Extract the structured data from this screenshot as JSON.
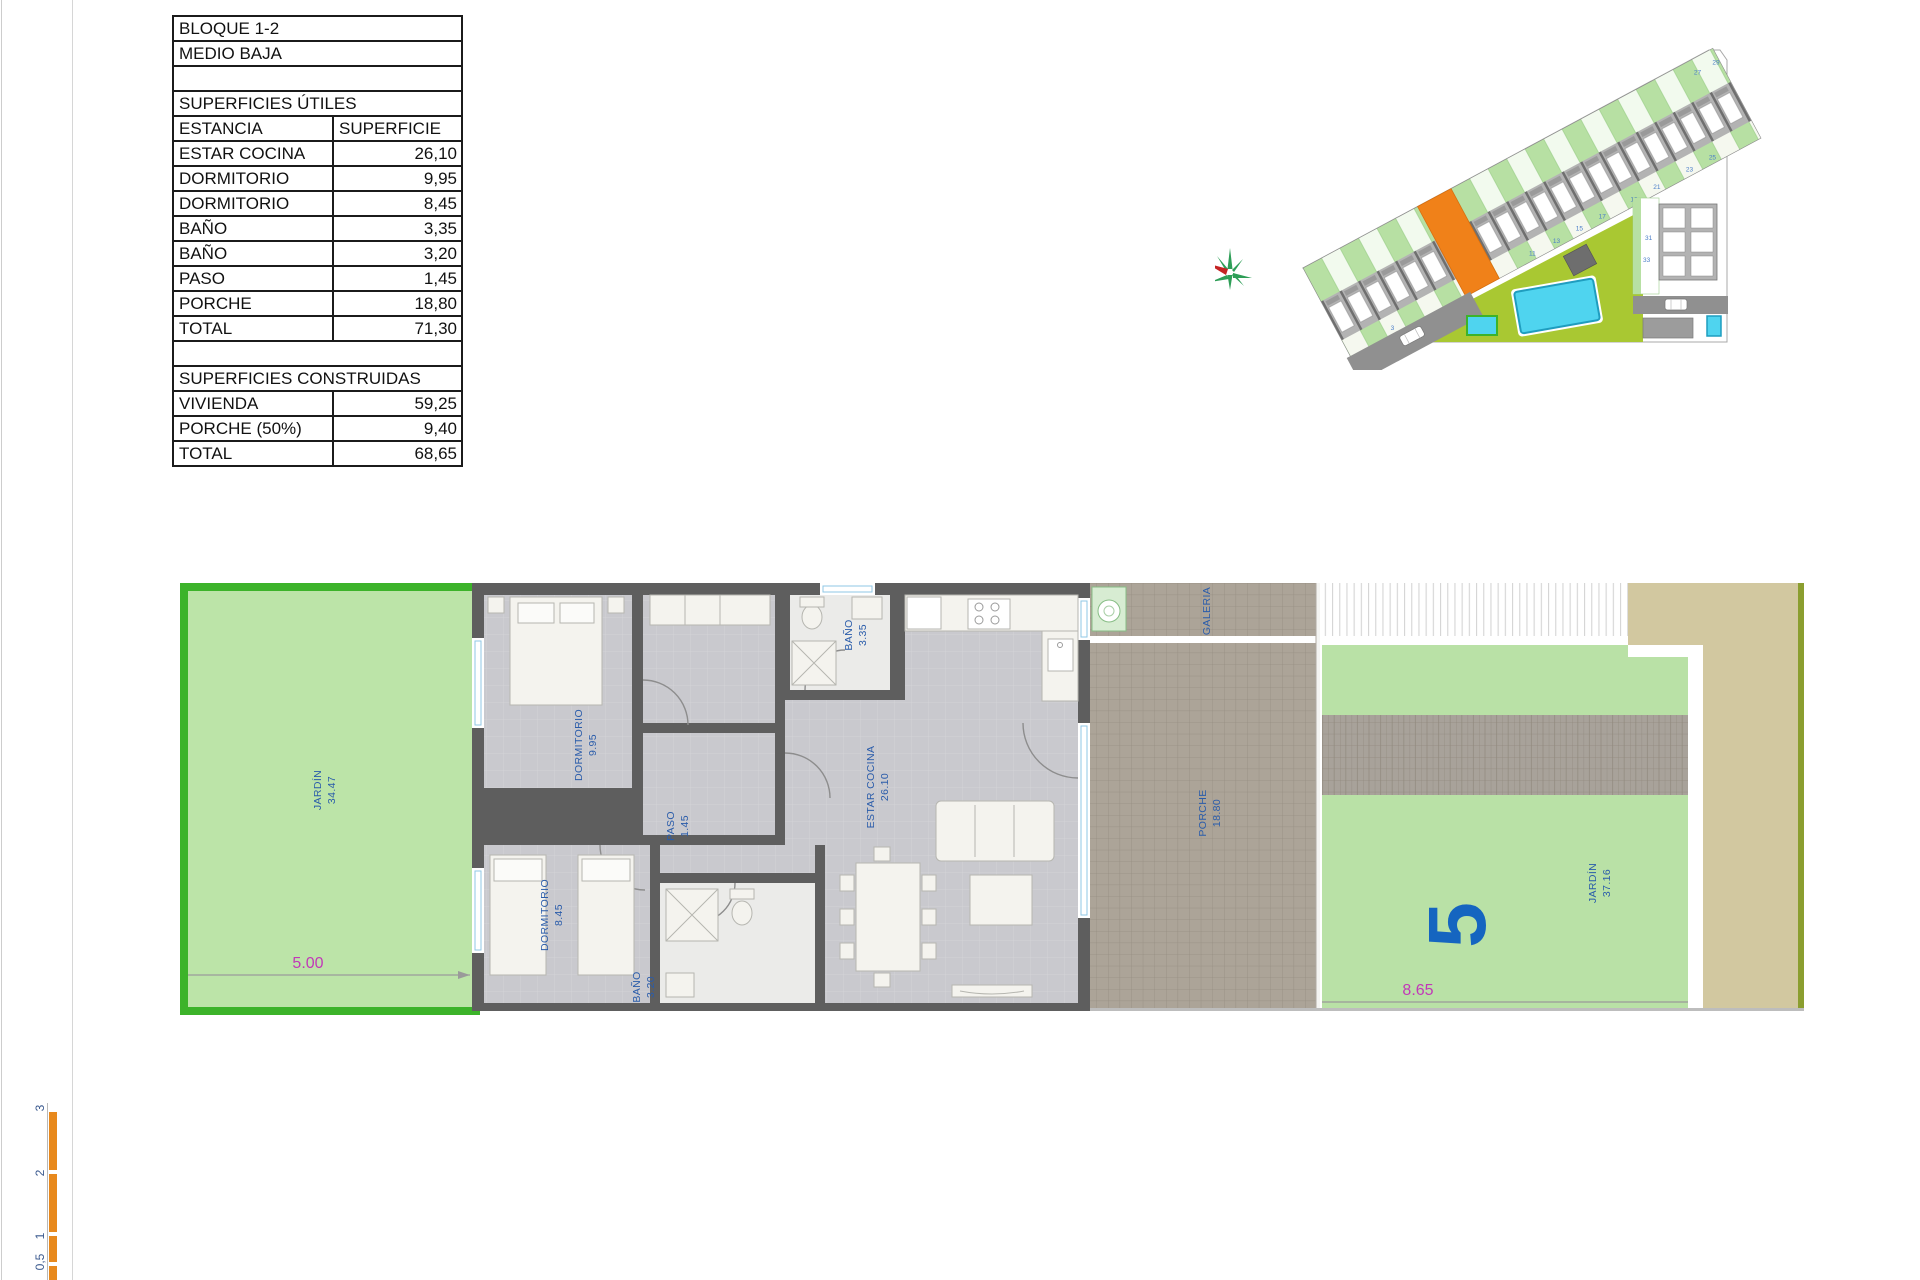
{
  "table": {
    "block": "BLOQUE 1-2",
    "floor": "MEDIO BAJA",
    "useful_title": "SUPERFICIES ÚTILES",
    "col_room": "ESTANCIA",
    "col_area": "SUPERFICIE",
    "useful_rows": [
      [
        "ESTAR COCINA",
        "26,10"
      ],
      [
        "DORMITORIO",
        "9,95"
      ],
      [
        "DORMITORIO",
        "8,45"
      ],
      [
        "BAÑO",
        "3,35"
      ],
      [
        "BAÑO",
        "3,20"
      ],
      [
        "PASO",
        "1,45"
      ],
      [
        "PORCHE",
        "18,80"
      ],
      [
        "TOTAL",
        "71,30"
      ]
    ],
    "built_title": "SUPERFICIES CONSTRUIDAS",
    "built_rows": [
      [
        "VIVIENDA",
        "59,25"
      ],
      [
        "PORCHE (50%)",
        "9,40"
      ],
      [
        "TOTAL",
        "68,65"
      ]
    ]
  },
  "plan": {
    "jardin_front": {
      "name": "JARDÍN",
      "area": "34.47"
    },
    "dormitorio1": {
      "name": "DORMITORIO",
      "area": "9.95"
    },
    "dormitorio2": {
      "name": "DORMITORIO",
      "area": "8.45"
    },
    "bano1": {
      "name": "BAÑO",
      "area": "3.35"
    },
    "bano2": {
      "name": "BAÑO",
      "area": "3.20"
    },
    "paso": {
      "name": "PASO",
      "area": "1.45"
    },
    "estar": {
      "name": "ESTAR COCINA",
      "area": "26.10"
    },
    "porche": {
      "name": "PORCHE",
      "area": "18.80"
    },
    "galeria": {
      "name": "GALERIA"
    },
    "jardin_back": {
      "name": "JARDÍN",
      "area": "37.16"
    },
    "unit_number": "5",
    "dim_front": "5.00",
    "dim_back": "8.65"
  },
  "scale_bar": {
    "labels": [
      "3",
      "2",
      "1",
      "0,5"
    ]
  },
  "site": {
    "unit_numbers": [
      "3",
      "11",
      "13",
      "15",
      "17",
      "19",
      "21",
      "23",
      "25",
      "27",
      "29"
    ],
    "block_numbers": [
      "31",
      "33"
    ]
  },
  "colors": {
    "garden_border": "#3CB32A",
    "garden_fill": "#BCE4A8",
    "wall_gray": "#5E5E5E",
    "floor_gray": "#C9C9CE",
    "porch_tile": "#ACA498",
    "tan_block": "#D2C8A0",
    "olive_edge": "#8B9E2F",
    "label_blue": "#2A5CAA",
    "dimension_magenta": "#C238B8",
    "unit_highlight_orange": "#F08119",
    "lawn_green": "#A9C832",
    "pool_cyan": "#4FD4EF",
    "scale_bar_orange": "#E8891D"
  }
}
